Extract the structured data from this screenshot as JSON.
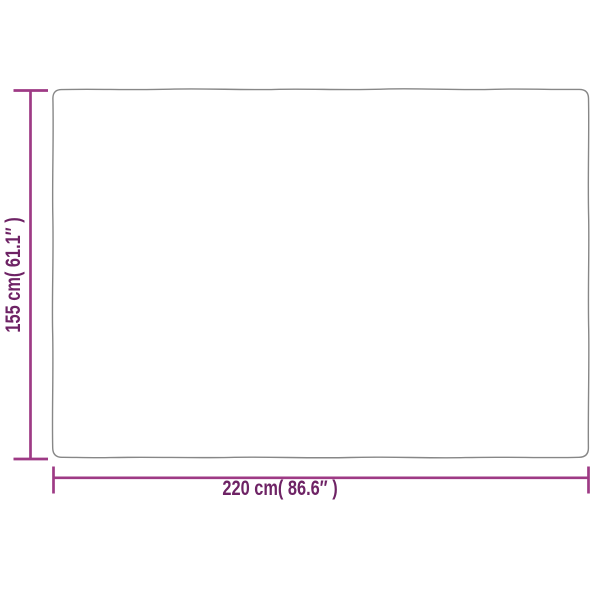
{
  "diagram": {
    "kind": "product-dimension-diagram",
    "width_label": "220 cm( 86.6″ )",
    "height_label": "155 cm( 61.1″ )",
    "dimensions": {
      "width_cm": "220",
      "width_in": "86.6",
      "height_cm": "155",
      "height_in": "61.1"
    },
    "colors": {
      "background": "#ffffff",
      "product_outline": "#878787",
      "dimension_line": "#9e3a85",
      "label_text": "#6e2365"
    }
  }
}
